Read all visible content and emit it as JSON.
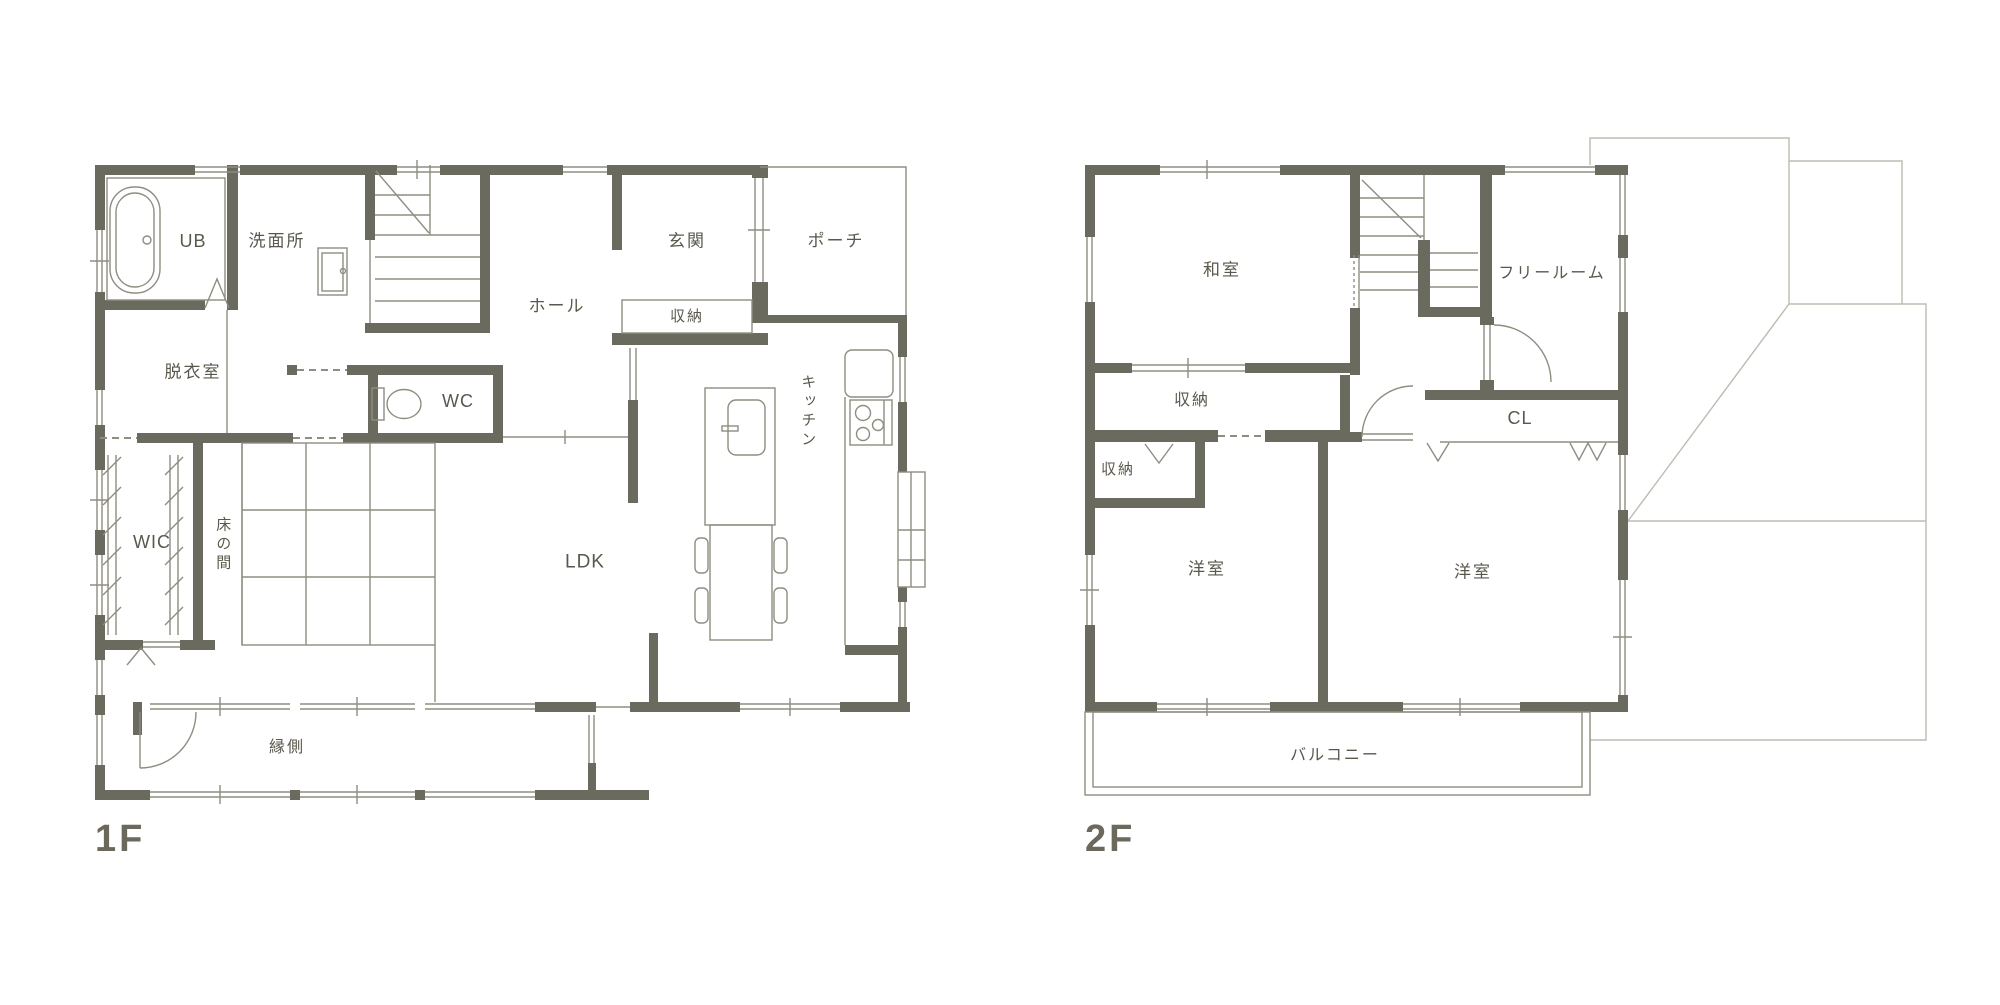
{
  "document": {
    "type": "floorplan",
    "language": "ja"
  },
  "colors": {
    "wall": "#6b6a5e",
    "thin_line": "#8f8d81",
    "roof_line": "#bdbbb1",
    "label_text": "#5a584c",
    "title_text": "#6b695d",
    "background": "#ffffff"
  },
  "floor1": {
    "title": "1F",
    "rooms": {
      "ub": "UB",
      "senmenjo": "洗面所",
      "genkan": "玄関",
      "porch": "ポーチ",
      "genkan_shuno": "収納",
      "hall": "ホール",
      "wc": "WC",
      "datsuishitsu": "脱衣室",
      "wic": "WIC",
      "tokonoma": "床の間",
      "kitchen": "キッチン",
      "ldk": "LDK",
      "engawa": "縁側"
    }
  },
  "floor2": {
    "title": "2F",
    "rooms": {
      "washitsu": "和室",
      "free_room": "フリールーム",
      "shuno_upper": "収納",
      "shuno_lower": "収納",
      "cl": "CL",
      "yoshitsu_left": "洋室",
      "yoshitsu_right": "洋室",
      "balcony": "バルコニー"
    }
  }
}
